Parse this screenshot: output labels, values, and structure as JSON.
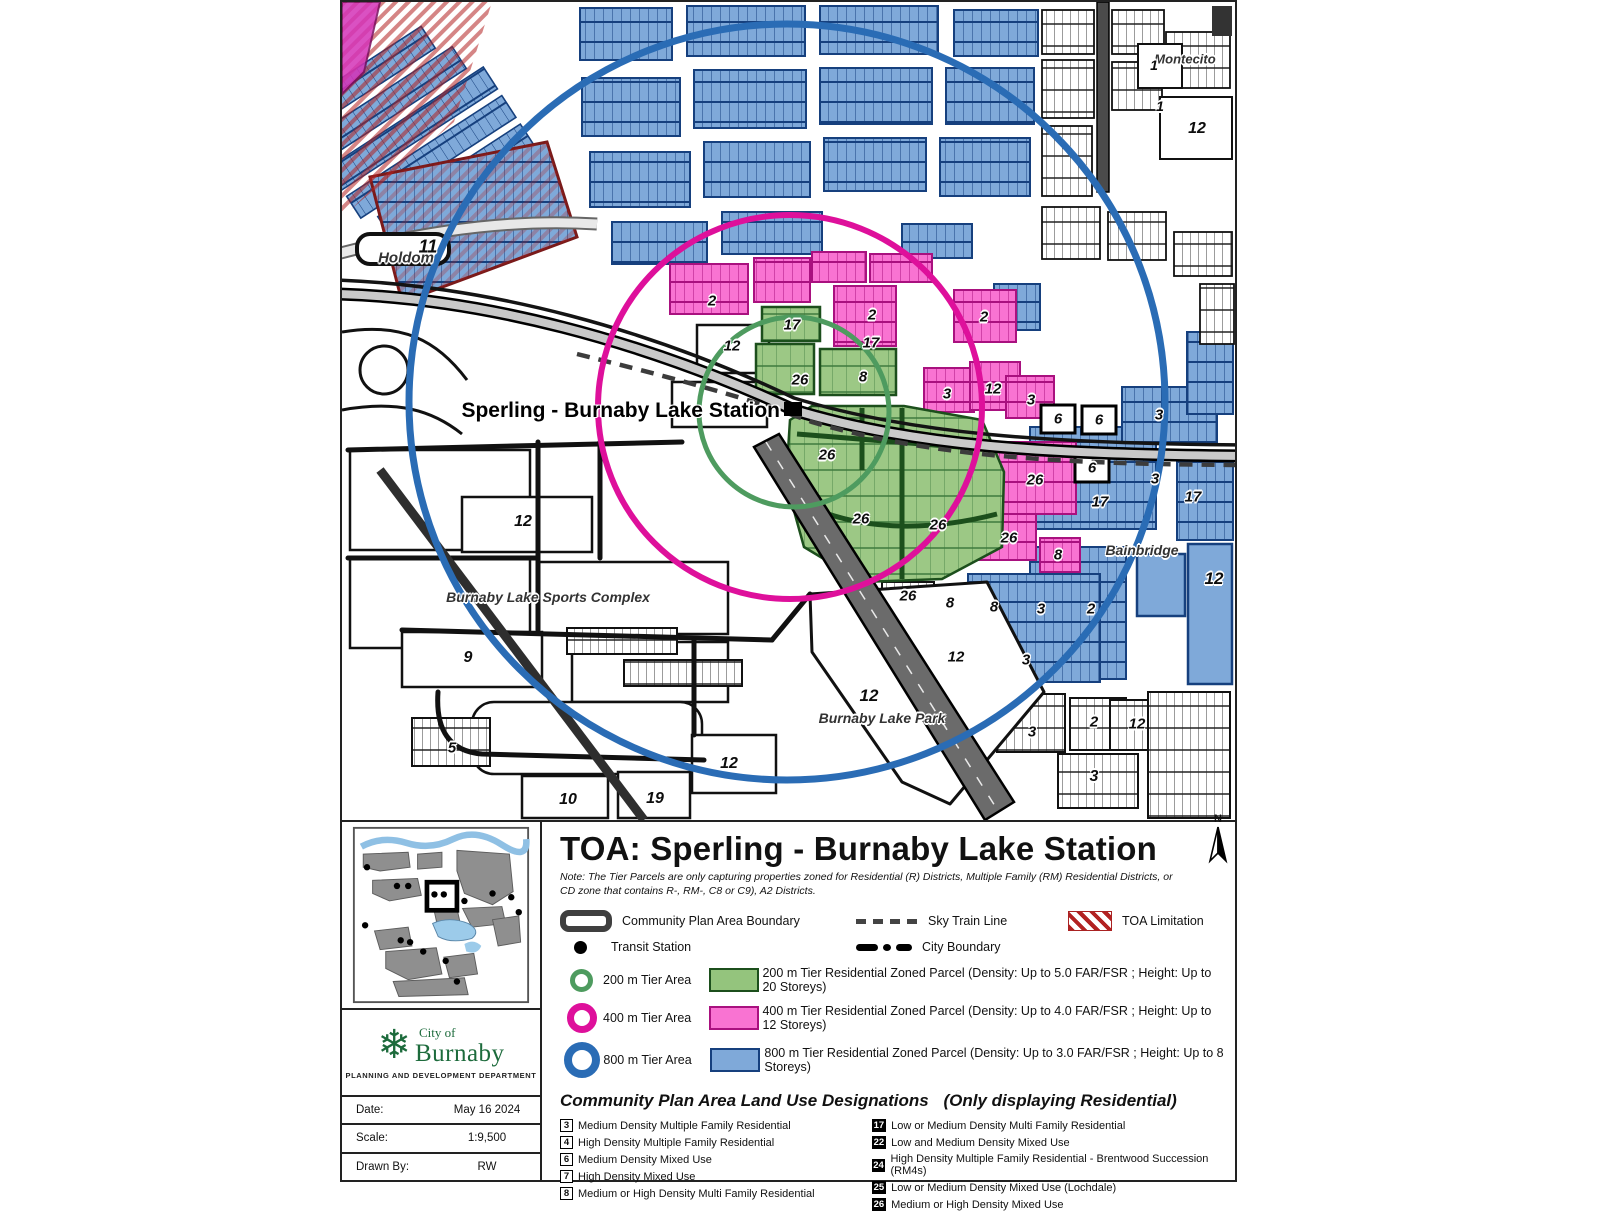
{
  "colors": {
    "parcel_green": "#94C47D",
    "parcel_green_border": "#1C4F1C",
    "ring_200m": "#4E9B5F",
    "parcel_pink": "#F973D2",
    "parcel_pink_border": "#A9117F",
    "ring_400m": "#DE109B",
    "parcel_blue": "#7FA9D9",
    "parcel_blue_border": "#16407E",
    "ring_800m": "#2A6CB5",
    "toa_hatch_red": "#B22222",
    "road_black": "#111111",
    "logo_green": "#1D6B3C"
  },
  "map": {
    "station_label": "Sperling - Burnaby Lake Station",
    "labels": [
      {
        "text": "11",
        "x": 86,
        "y": 245,
        "size": 18
      },
      {
        "text": "Holdom",
        "x": 64,
        "y": 256,
        "kind": "place"
      },
      {
        "text": "Montecito",
        "x": 843,
        "y": 57,
        "kind": "place",
        "size": 13
      },
      {
        "text": "1",
        "x": 812,
        "y": 63,
        "size": 14
      },
      {
        "text": "1",
        "x": 818,
        "y": 104,
        "size": 14
      },
      {
        "text": "12",
        "x": 855,
        "y": 127,
        "size": 16
      },
      {
        "text": "2",
        "x": 370,
        "y": 299
      },
      {
        "text": "17",
        "x": 450,
        "y": 323
      },
      {
        "text": "2",
        "x": 530,
        "y": 313
      },
      {
        "text": "17",
        "x": 529,
        "y": 341
      },
      {
        "text": "2",
        "x": 642,
        "y": 315
      },
      {
        "text": "12",
        "x": 390,
        "y": 344
      },
      {
        "text": "26",
        "x": 458,
        "y": 378
      },
      {
        "text": "8",
        "x": 521,
        "y": 375
      },
      {
        "text": "3",
        "x": 605,
        "y": 392
      },
      {
        "text": "12",
        "x": 651,
        "y": 387
      },
      {
        "text": "3",
        "x": 689,
        "y": 398
      },
      {
        "text": "6",
        "x": 716,
        "y": 417
      },
      {
        "text": "6",
        "x": 757,
        "y": 418
      },
      {
        "text": "6",
        "x": 750,
        "y": 466
      },
      {
        "text": "3",
        "x": 817,
        "y": 413
      },
      {
        "text": "26",
        "x": 485,
        "y": 453
      },
      {
        "text": "26",
        "x": 693,
        "y": 478
      },
      {
        "text": "3",
        "x": 813,
        "y": 477
      },
      {
        "text": "17",
        "x": 758,
        "y": 500
      },
      {
        "text": "17",
        "x": 851,
        "y": 495
      },
      {
        "text": "26",
        "x": 519,
        "y": 517
      },
      {
        "text": "26",
        "x": 596,
        "y": 523
      },
      {
        "text": "26",
        "x": 667,
        "y": 536
      },
      {
        "text": "8",
        "x": 716,
        "y": 553
      },
      {
        "text": "Bainbridge",
        "x": 800,
        "y": 548,
        "kind": "place",
        "size": 14
      },
      {
        "text": "12",
        "x": 872,
        "y": 577,
        "size": 17
      },
      {
        "text": "12",
        "x": 181,
        "y": 520,
        "size": 16
      },
      {
        "text": "26",
        "x": 566,
        "y": 594
      },
      {
        "text": "8",
        "x": 608,
        "y": 601
      },
      {
        "text": "8",
        "x": 652,
        "y": 605
      },
      {
        "text": "3",
        "x": 699,
        "y": 607
      },
      {
        "text": "2",
        "x": 749,
        "y": 607
      },
      {
        "text": "Burnaby Lake Sports Complex",
        "x": 206,
        "y": 595,
        "kind": "place",
        "size": 14
      },
      {
        "text": "12",
        "x": 614,
        "y": 655
      },
      {
        "text": "3",
        "x": 684,
        "y": 658
      },
      {
        "text": "9",
        "x": 126,
        "y": 656,
        "size": 16
      },
      {
        "text": "12",
        "x": 527,
        "y": 694,
        "size": 17
      },
      {
        "text": "Burnaby Lake Park",
        "x": 540,
        "y": 716,
        "kind": "place",
        "size": 14
      },
      {
        "text": "3",
        "x": 690,
        "y": 730
      },
      {
        "text": "2",
        "x": 752,
        "y": 720
      },
      {
        "text": "12",
        "x": 795,
        "y": 722
      },
      {
        "text": "5",
        "x": 110,
        "y": 746,
        "size": 15
      },
      {
        "text": "3",
        "x": 752,
        "y": 775,
        "size": 16
      },
      {
        "text": "12",
        "x": 387,
        "y": 762,
        "size": 16
      },
      {
        "text": "10",
        "x": 226,
        "y": 798,
        "size": 16
      },
      {
        "text": "19",
        "x": 313,
        "y": 797,
        "size": 16
      }
    ]
  },
  "panel": {
    "title": "TOA: Sperling - Burnaby Lake Station",
    "note": "Note: The Tier Parcels are only capturing properties zoned for Residential (R) Districts, Multiple Family (RM) Residential Districts, or CD zone that contains R-, RM-, C8 or C9), A2 Districts.",
    "north_label": "N",
    "legend": {
      "community_boundary": "Community Plan Area Boundary",
      "skytrain": "Sky Train Line",
      "toa_limitation": "TOA Limitation",
      "transit_station": "Transit Station",
      "city_boundary": "City Boundary",
      "tiers": [
        {
          "area": "200 m Tier Area",
          "parcel": "200 m Tier Residential Zoned Parcel (Density: Up to 5.0 FAR/FSR ; Height: Up to 20 Storeys)"
        },
        {
          "area": "400 m Tier Area",
          "parcel": "400 m Tier Residential Zoned Parcel (Density: Up to 4.0 FAR/FSR ; Height: Up to 12 Storeys)"
        },
        {
          "area": "800 m Tier Area",
          "parcel": "800 m Tier Residential Zoned Parcel (Density: Up to 3.0 FAR/FSR ; Height: Up to 8 Storeys)"
        }
      ]
    },
    "land_use": {
      "heading": "Community Plan Area Land Use Designations",
      "subheading": "(Only displaying Residential)",
      "col1": [
        {
          "num": "3",
          "label": "Medium Density Multiple Family Residential"
        },
        {
          "num": "4",
          "label": "High Density Multiple Family Residential"
        },
        {
          "num": "6",
          "label": "Medium Density Mixed Use"
        },
        {
          "num": "7",
          "label": "High Density Mixed Use"
        },
        {
          "num": "8",
          "label": "Medium or High Density Multi Family Residential"
        }
      ],
      "col2": [
        {
          "num": "17",
          "label": "Low or Medium Density Multi Family Residential"
        },
        {
          "num": "22",
          "label": "Low and Medium Density Mixed Use"
        },
        {
          "num": "24",
          "label": "High Density Multiple Family Residential - Brentwood Succession (RM4s)"
        },
        {
          "num": "25",
          "label": "Low or Medium Density Mixed Use (Lochdale)"
        },
        {
          "num": "26",
          "label": "Medium or High Density Mixed Use"
        }
      ]
    },
    "footer": {
      "logo_line1": "City of",
      "logo_line2": "Burnaby",
      "dept": "PLANNING AND DEVELOPMENT DEPARTMENT",
      "date_label": "Date:",
      "date_value": "May 16 2024",
      "scale_label": "Scale:",
      "scale_value": "1:9,500",
      "drawn_label": "Drawn By:",
      "drawn_value": "RW"
    }
  }
}
